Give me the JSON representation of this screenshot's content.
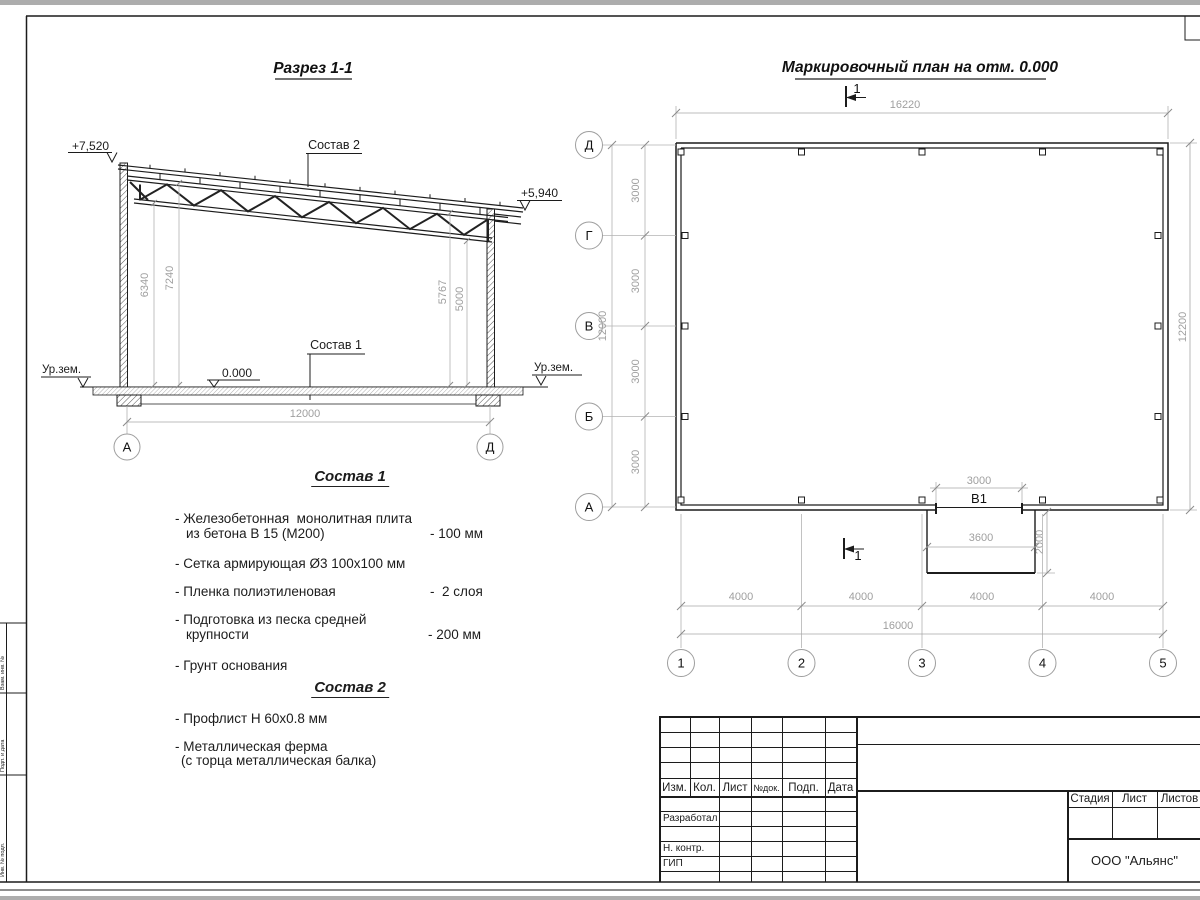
{
  "frame": {
    "side_labels": [
      "Взам. инв. №",
      "Подп. и дата",
      "Инв. № подл."
    ]
  },
  "section": {
    "title": "Разрез 1-1",
    "elev_left": "+7,520",
    "elev_right": "+5,940",
    "sostav2_label": "Состав 2",
    "sostav1_label": "Состав 1",
    "zero_level": "0.000",
    "ground_left": "Ур.зем.",
    "ground_right": "Ур.зем.",
    "dim_h_left_outer": "6340",
    "dim_h_left_inner": "7240",
    "dim_h_right_inner": "5767",
    "dim_h_right_outer": "5000",
    "dim_span": "12000",
    "axis_left": "А",
    "axis_right": "Д"
  },
  "plan": {
    "title": "Маркировочный план на отм. 0.000",
    "cut_mark": "1",
    "dim_top": "16220",
    "dim_right": "12200",
    "dim_left_total": "12000",
    "row_spacings": [
      "3000",
      "3000",
      "3000",
      "3000"
    ],
    "row_axes": [
      "Д",
      "Г",
      "В",
      "Б",
      "А"
    ],
    "col_axes": [
      "1",
      "2",
      "3",
      "4",
      "5"
    ],
    "col_spacings": [
      "4000",
      "4000",
      "4000",
      "4000"
    ],
    "dim_bottom_total": "16000",
    "opening_label": "В1",
    "opening_dim": "3000",
    "porch_width": "3600",
    "porch_depth": "2000"
  },
  "sostav1": {
    "title": "Состав 1",
    "item1_l1": "- Железобетонная  монолитная плита",
    "item1_l2": "из бетона В 15 (М200)",
    "item1_val": "- 100 мм",
    "item2": "- Сетка армирующая Ø3 100х100 мм",
    "item3": "- Пленка полиэтиленовая",
    "item3_val": "-  2 слоя",
    "item4_l1": "- Подготовка из песка средней",
    "item4_l2": "крупности",
    "item4_val": "- 200 мм",
    "item5": "- Грунт основания"
  },
  "sostav2": {
    "title": "Состав 2",
    "item1": "- Профлист Н 60х0.8 мм",
    "item2_l1": "- Металлическая ферма",
    "item2_l2": "(с торца металлическая балка)"
  },
  "titleblock": {
    "cols": [
      "Изм.",
      "Кол.",
      "Лист",
      "№док.",
      "Подп.",
      "Дата"
    ],
    "row_developed": "Разработал",
    "row_ncontr": "Н. контр.",
    "row_gip": "ГИП",
    "stage": "Стадия",
    "sheet": "Лист",
    "sheets": "Листов",
    "company": "ООО \"Альянс\""
  }
}
